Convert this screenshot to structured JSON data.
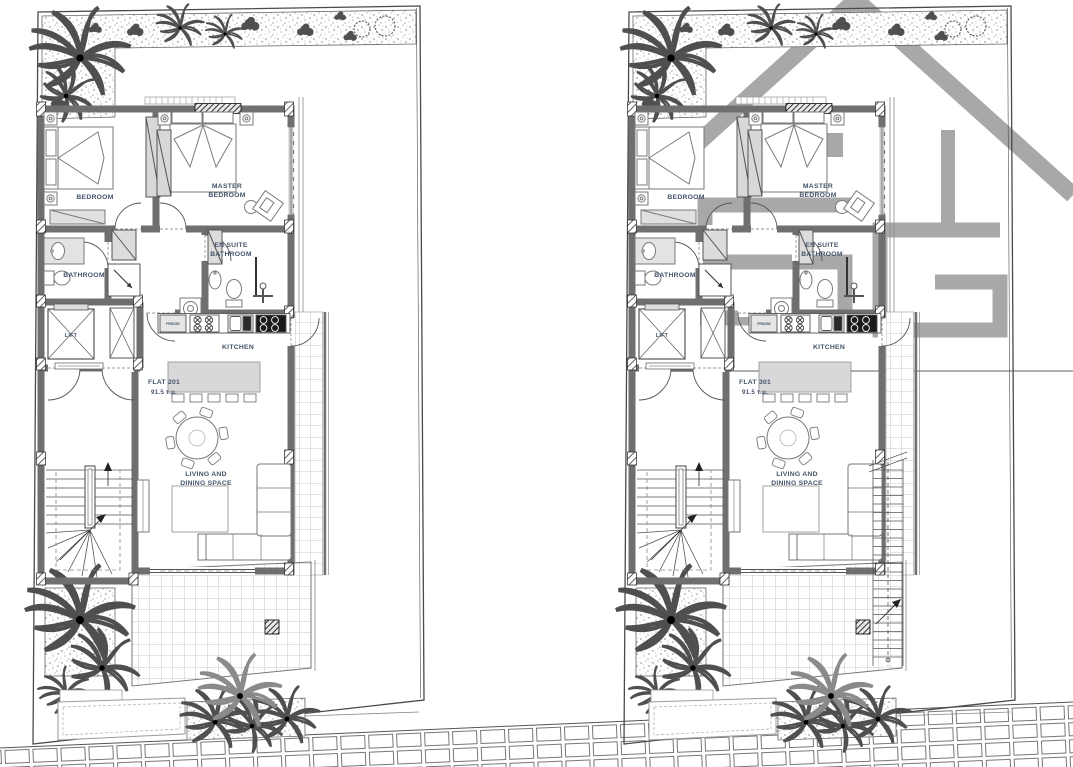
{
  "page": {
    "description": "Two architectural floor plan sheets side by side",
    "background": "#ffffff"
  },
  "colors": {
    "label_text": "#44546a",
    "wall_fill": "#6f6f6f",
    "line_work": "#555555",
    "light_furniture_fill": "#d8d8d8",
    "tile_line": "#b9b9b9",
    "watermark_gray": "#a8a8a8"
  },
  "icons": {
    "watermark": "house-roof-logo",
    "planting": "palm-tree-icon",
    "shrubs": "shrub-icon"
  },
  "plans": [
    {
      "flat_name": "FLAT 201",
      "flat_area": "91.5 τ.μ.",
      "labels": {
        "bedroom": "BEDROOM",
        "master_1": "MASTER",
        "master_2": "BEDROOM",
        "bathroom": "BATHROOM",
        "ensuite_1": "EN SUITE",
        "ensuite_2": "BATHROOM",
        "kitchen": "KITCHEN",
        "living_1": "LIVING AND",
        "living_2": "DINING SPACE",
        "lift": "LIFT",
        "fridge": "FRIDGE"
      }
    },
    {
      "flat_name": "FLAT 301",
      "flat_area": "91.5 τ.μ.",
      "labels": {
        "bedroom": "BEDROOM",
        "master_1": "MASTER",
        "master_2": "BEDROOM",
        "bathroom": "BATHROOM",
        "ensuite_1": "EN SUITE",
        "ensuite_2": "BATHROOM",
        "kitchen": "KITCHEN",
        "living_1": "LIVING AND",
        "living_2": "DINING SPACE",
        "lift": "LIFT",
        "fridge": "FRIDGE"
      }
    }
  ]
}
